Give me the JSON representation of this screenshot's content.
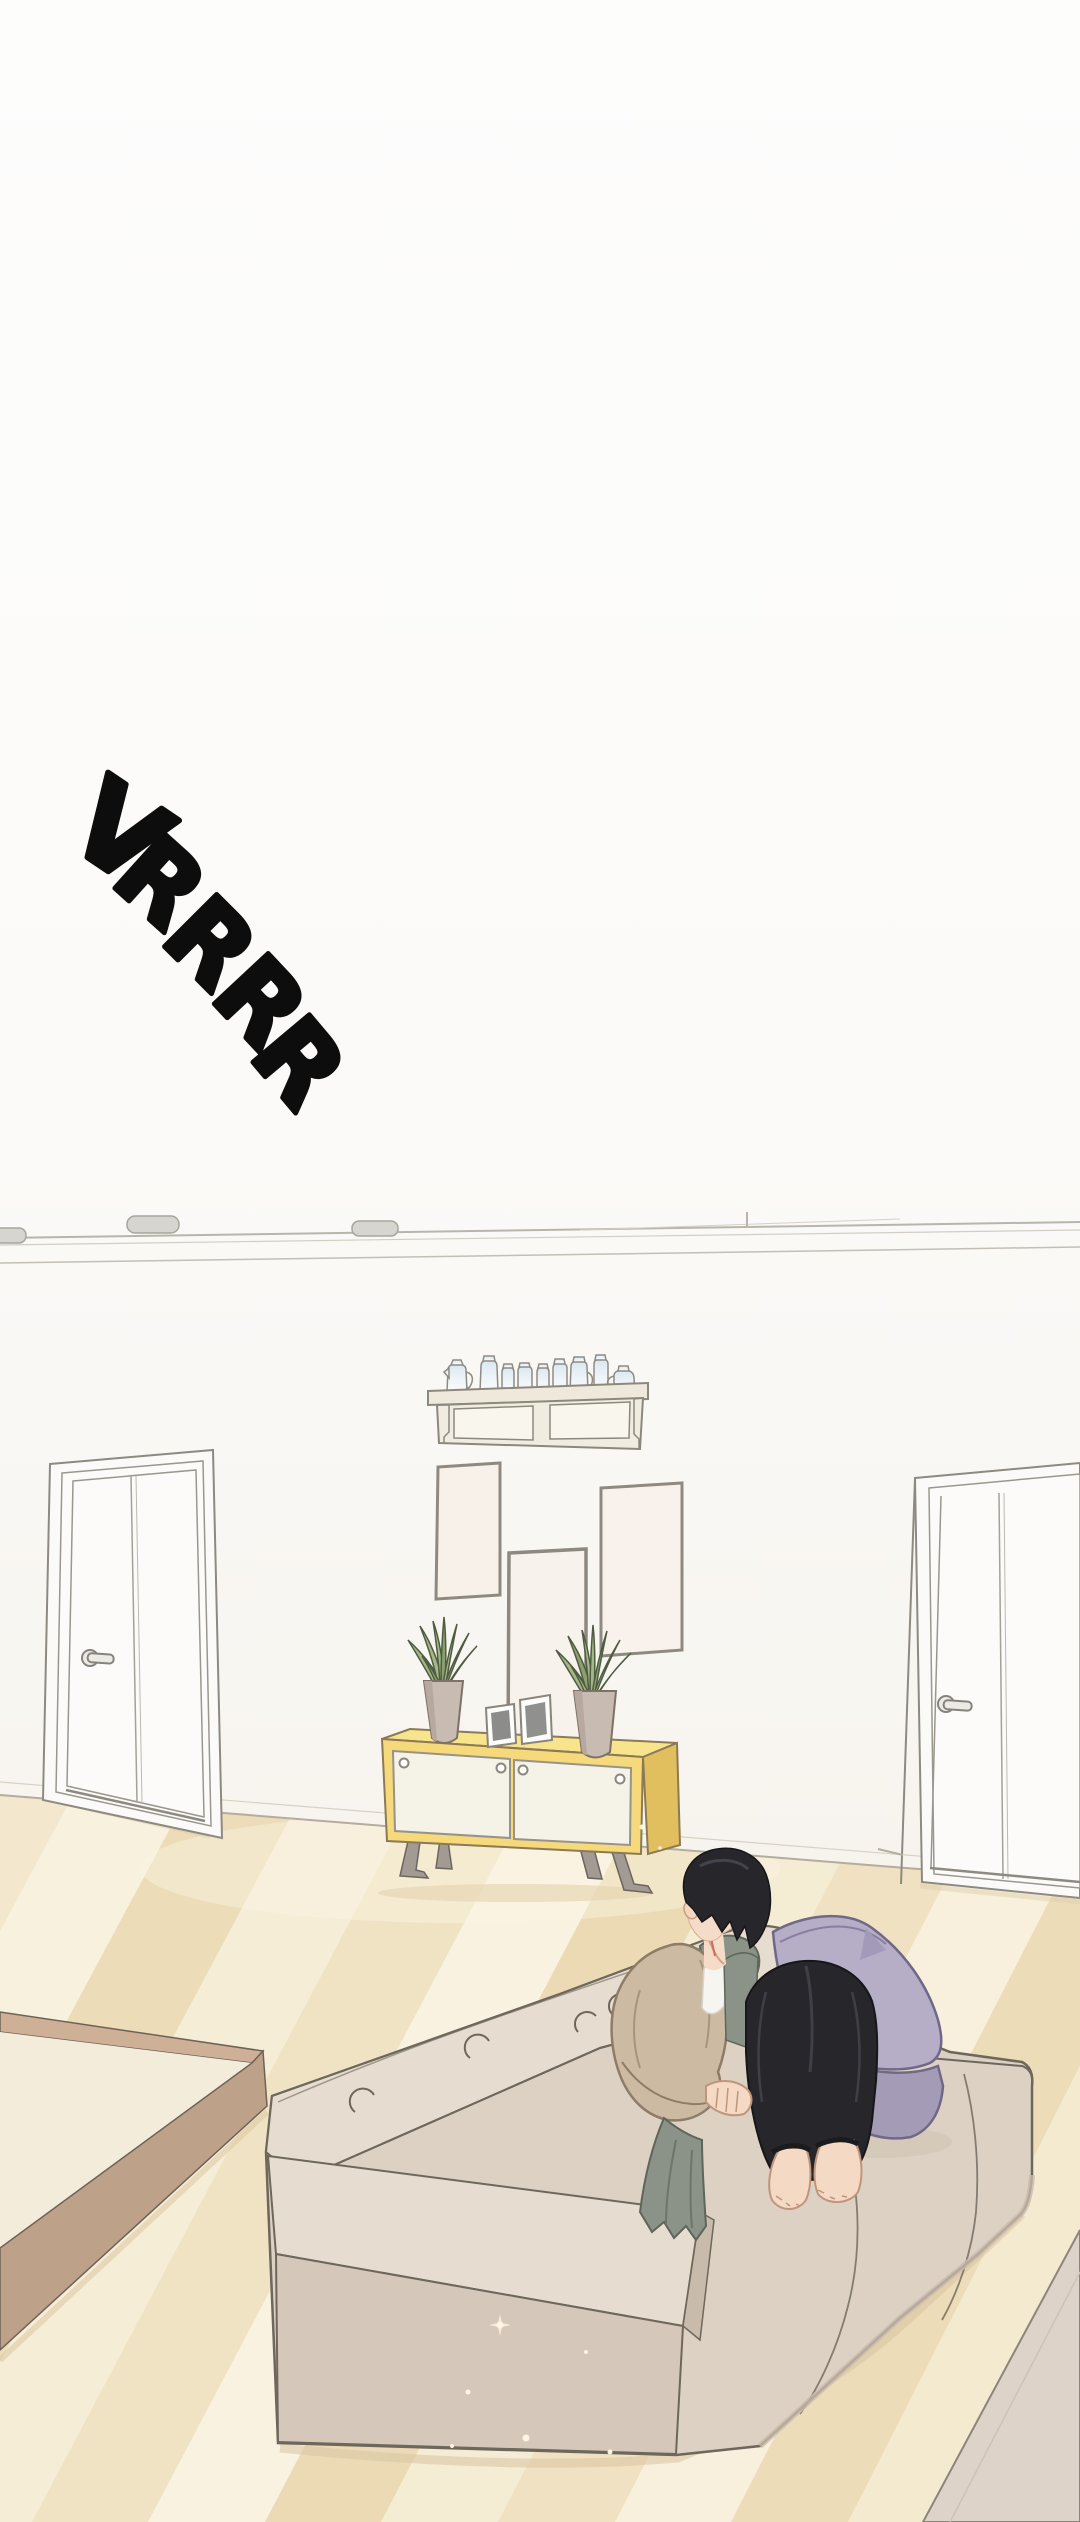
{
  "panel": {
    "kind": "webtoon-comic-panel",
    "setting": "living-room-interior"
  },
  "sfx": {
    "text": "VRRRR",
    "letters": [
      "V",
      "R",
      "R",
      "R",
      "R"
    ]
  },
  "palette": {
    "background": "#fcfbfa",
    "wall": "#f8f6f2",
    "floor_light": "#f8f0dc",
    "floor_dark": "#ecdcb8",
    "cabinet_yellow": "#f5d97a",
    "cabinet_yellow_side": "#e2bf5e",
    "sofa_beige": "#dcd1c3",
    "sofa_light": "#e6ddd0",
    "pillow_lavender": "#b5aec6",
    "pillow_shadow": "#a49cb7",
    "plant_green": "#a3b886",
    "pot_taupe": "#c8bbb2",
    "hair_black": "#26262b",
    "pants_black": "#27272b",
    "cardigan_tan": "#cdbaa3",
    "hoodie_gray": "#8b9288",
    "skin": "#f5dcc9",
    "platform_wood": "#bda189",
    "rug": "#ded3c9",
    "outline": "#6e675c"
  },
  "scene": {
    "objects": [
      "ceiling-lights",
      "left-door",
      "right-door",
      "wall-shelf-with-jars",
      "wall-frame-left",
      "wall-mirror-center",
      "wall-frame-right",
      "potted-plant-left",
      "potted-plant-right",
      "photo-frame-small",
      "photo-frame-large",
      "yellow-sideboard",
      "wood-platform",
      "sofa",
      "lavender-pillows",
      "sitting-character",
      "area-rug"
    ]
  }
}
